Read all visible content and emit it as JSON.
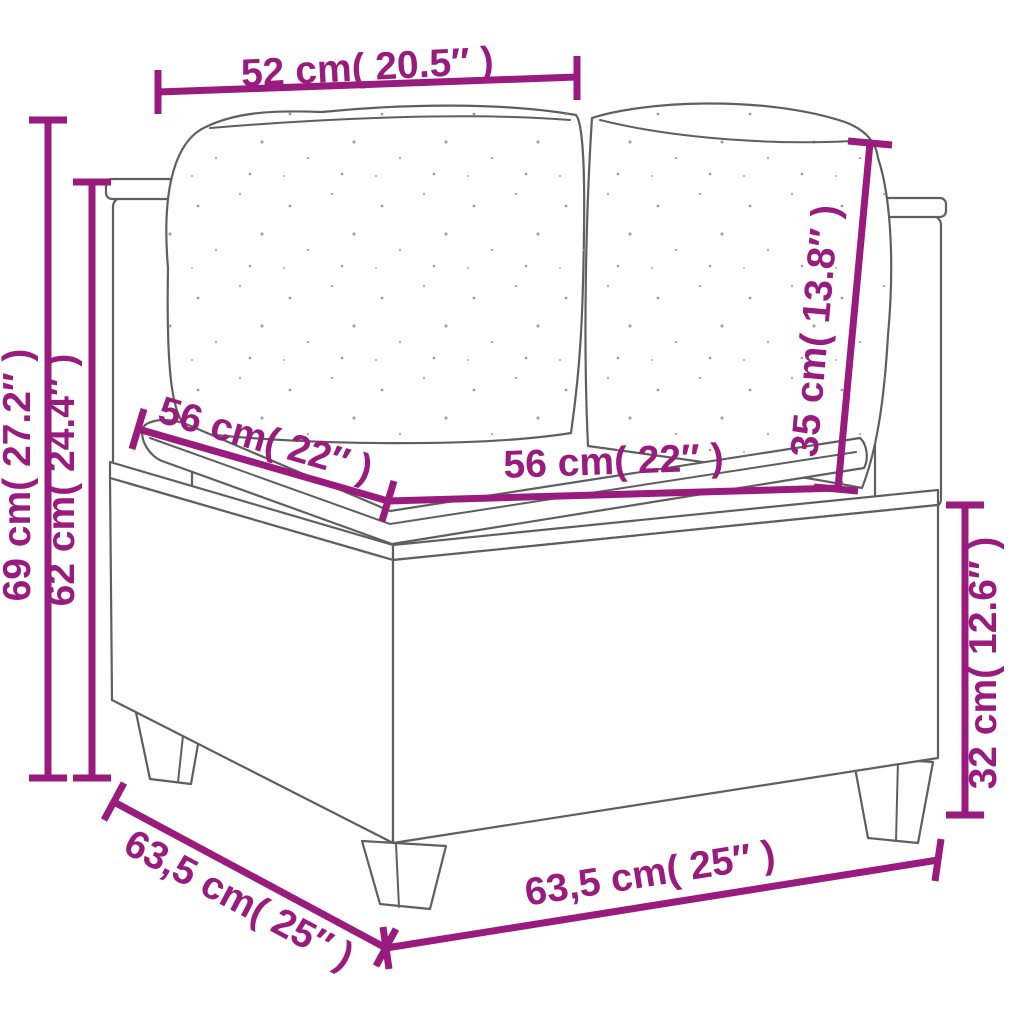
{
  "palette": {
    "annotation": "#9a1b7e",
    "line_art": "#5f5f5f",
    "background": "#ffffff"
  },
  "figure": {
    "subject": "poly-rattan corner sofa line drawing",
    "parts": [
      "back-cushion-left",
      "back-cushion-right",
      "seat-cushion",
      "wicker-base",
      "wicker-post-left",
      "wicker-post-right",
      "legs"
    ]
  },
  "dims": {
    "top_width": {
      "label": "52 cm( 20.5″ )"
    },
    "total_height": {
      "label": "69 cm( 27.2″ )"
    },
    "back_height": {
      "label": "62 cm( 24.4″ )"
    },
    "seat_depth": {
      "label": "56 cm( 22″ )"
    },
    "seat_width": {
      "label": "56 cm( 22″ )"
    },
    "cushion_height": {
      "label": "35 cm( 13.8″ )"
    },
    "base_height": {
      "label": "32 cm( 12.6″ )"
    },
    "side_depth": {
      "label": "63,5 cm( 25″ )"
    },
    "front_width": {
      "label": "63,5 cm( 25″ )"
    }
  }
}
